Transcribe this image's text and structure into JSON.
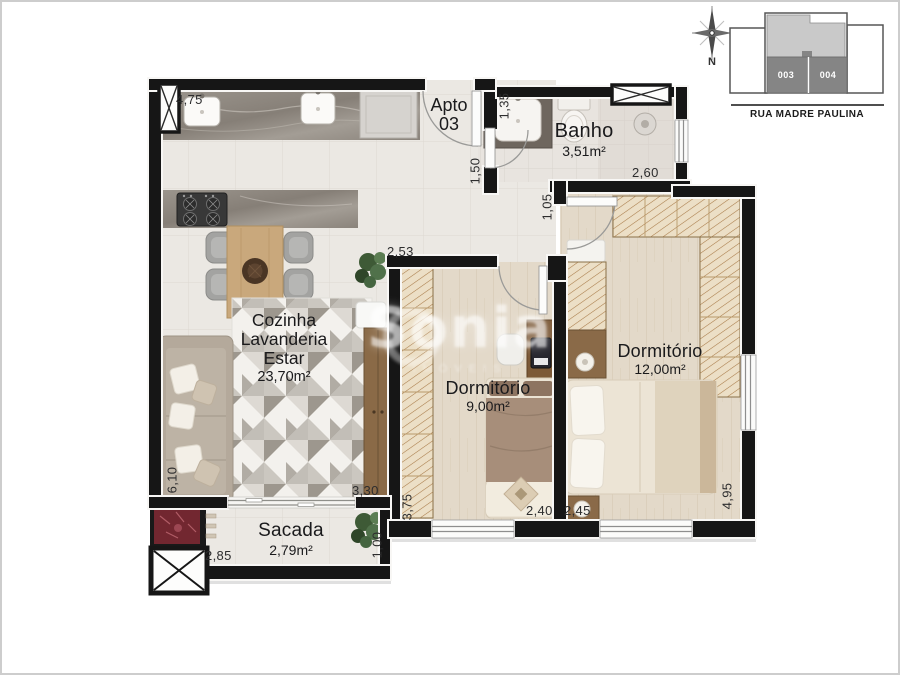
{
  "inset": {
    "north_label": "N",
    "street_name": "RUA MADRE PAULINA",
    "unit_left": "003",
    "unit_right": "004"
  },
  "plan": {
    "apto": {
      "line1": "Apto",
      "line2": "03"
    },
    "rooms": {
      "banho": {
        "name": "Banho",
        "area": "3,51m²"
      },
      "living": {
        "line1": "Cozinha",
        "line2": "Lavanderia",
        "line3": "Estar",
        "area": "23,70m²"
      },
      "dorm1": {
        "name": "Dormitório",
        "area": "9,00m²"
      },
      "dorm2": {
        "name": "Dormitório",
        "area": "12,00m²"
      },
      "sacada": {
        "name": "Sacada",
        "area": "2,79m²"
      }
    },
    "dimensions": {
      "kitchen_top": "4,75",
      "banho_entry_depth": "1,35",
      "entry_hall": "1,50",
      "banho_width": "2,60",
      "hall_passage": "1,05",
      "dorm1_hall_width": "2,53",
      "living_bottom": "3,30",
      "dorm1_depth": "3,75",
      "dorm1_width": "2,40",
      "dorm2_width": "2,45",
      "dorm2_depth": "4,95",
      "living_depth": "6,10",
      "sacada_width": "2,85",
      "sacada_depth": "1,00"
    }
  },
  "watermark": {
    "brand": "Sonia",
    "tagline": "IMÓVEIS"
  },
  "colors": {
    "wall": "#161616",
    "marble_counter": "#8d8781",
    "tile_floor": "#ebe8e3",
    "wood_floor": "#e3d9c9",
    "wardrobe_hatch": "#a87a48",
    "churrasqueira_red": "#722730",
    "inset_units_gray": "#858585",
    "inset_upper_gray": "#c9c9c9"
  }
}
